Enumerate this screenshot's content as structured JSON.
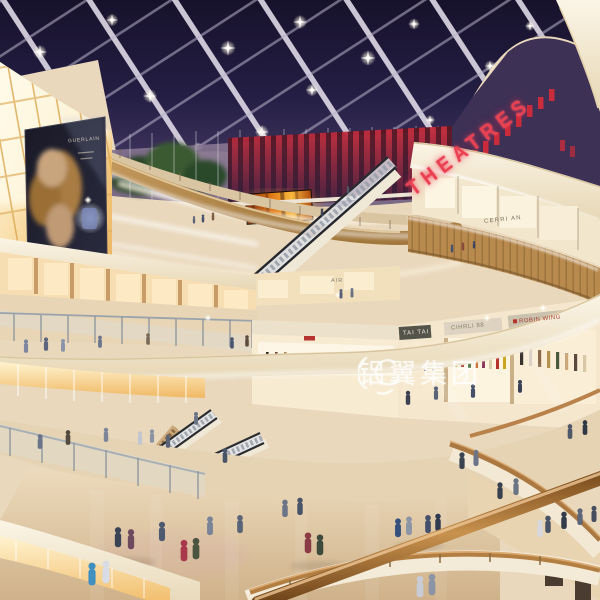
{
  "signs": {
    "theatres": "THEATRES",
    "shop_level4": "CERRI AN",
    "shop_air": "AIR",
    "shop_tai_tai": "TAI TAI",
    "shop_cihrli": "CIHRLI 88",
    "shop_robin_wing": "ROBIN WING",
    "billboard_brand": "GUERLAIN"
  },
  "watermark": {
    "text": "铝翼集团"
  },
  "palette": {
    "skylight_navy": "#241e44",
    "beam_white": "#ded9e6",
    "theatre_red": "#c92c3b",
    "amber_tile": "#f6cf87",
    "fascia_cream": "#f3ead8",
    "wood_rail": "#a9763c",
    "floor_beige": "#d9c09c",
    "glow_amber": "#f0b964",
    "tree_green": "#3a5a33",
    "led_fire_orange": "#e07818"
  }
}
